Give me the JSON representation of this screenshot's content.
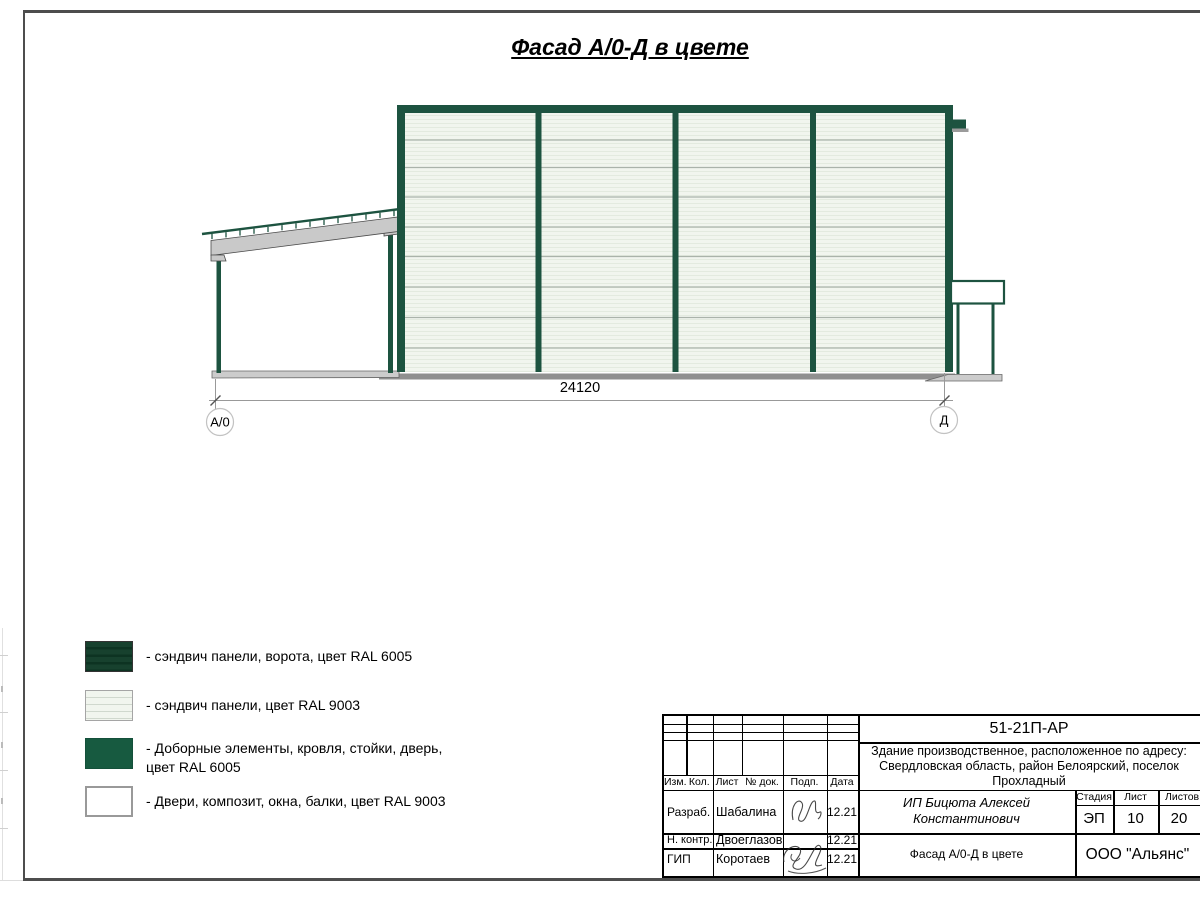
{
  "page": {
    "title": "Фасад А/0-Д в цвете"
  },
  "drawing": {
    "dimension": "24120",
    "axis_left": "А/0",
    "axis_right": "Д"
  },
  "legend": {
    "items": [
      {
        "label": "- сэндвич панели, ворота, цвет RAL 6005"
      },
      {
        "label": "- сэндвич панели, цвет RAL 9003"
      },
      {
        "label": "- Доборные элементы, кровля, стойки, дверь,",
        "label2": "цвет RAL 6005"
      },
      {
        "label": "- Двери, композит, окна, балки, цвет RAL 9003"
      }
    ]
  },
  "title_block": {
    "doc_number": "51-21П-АР",
    "address_line1": "Здание производственное, расположенное по адресу:",
    "address_line2": "Свердловская область, район Белоярский, поселок",
    "address_line3": "Прохладный",
    "headers": {
      "izm": "Изм.",
      "kol": "Кол.",
      "list": "Лист",
      "doc": "№ док.",
      "podp": "Подп.",
      "data": "Дата"
    },
    "rows": [
      {
        "role": "Разраб.",
        "name": "Шабалина",
        "date": "12.21"
      },
      {
        "role": "Н. контр.",
        "name": "Двоеглазов",
        "date": "12.21"
      },
      {
        "role": "ГИП",
        "name": "Коротаев",
        "date": "12.21"
      }
    ],
    "client": "ИП Бицюта Алексей Константинович",
    "stage_header": "Стадия",
    "sheet_header": "Лист",
    "sheets_header": "Листов",
    "stage": "ЭП",
    "sheet": "10",
    "sheets": "20",
    "drawing_name": "Фасад А/0-Д в цвете",
    "company": "ООО \"Альянс\""
  },
  "colors": {
    "ral6005_frame": "#1d5340",
    "ral6005_gate": "#17412e",
    "ral6005_gate_stripe": "#0d3322",
    "ral9003_panel": "#f1f5ee",
    "panel_stripe": "#e3eadf",
    "panel_joint": "#aab3aa",
    "ground_dark": "#909090",
    "slab_gray": "#cccccc",
    "beam_gray": "#c9c9c9"
  }
}
